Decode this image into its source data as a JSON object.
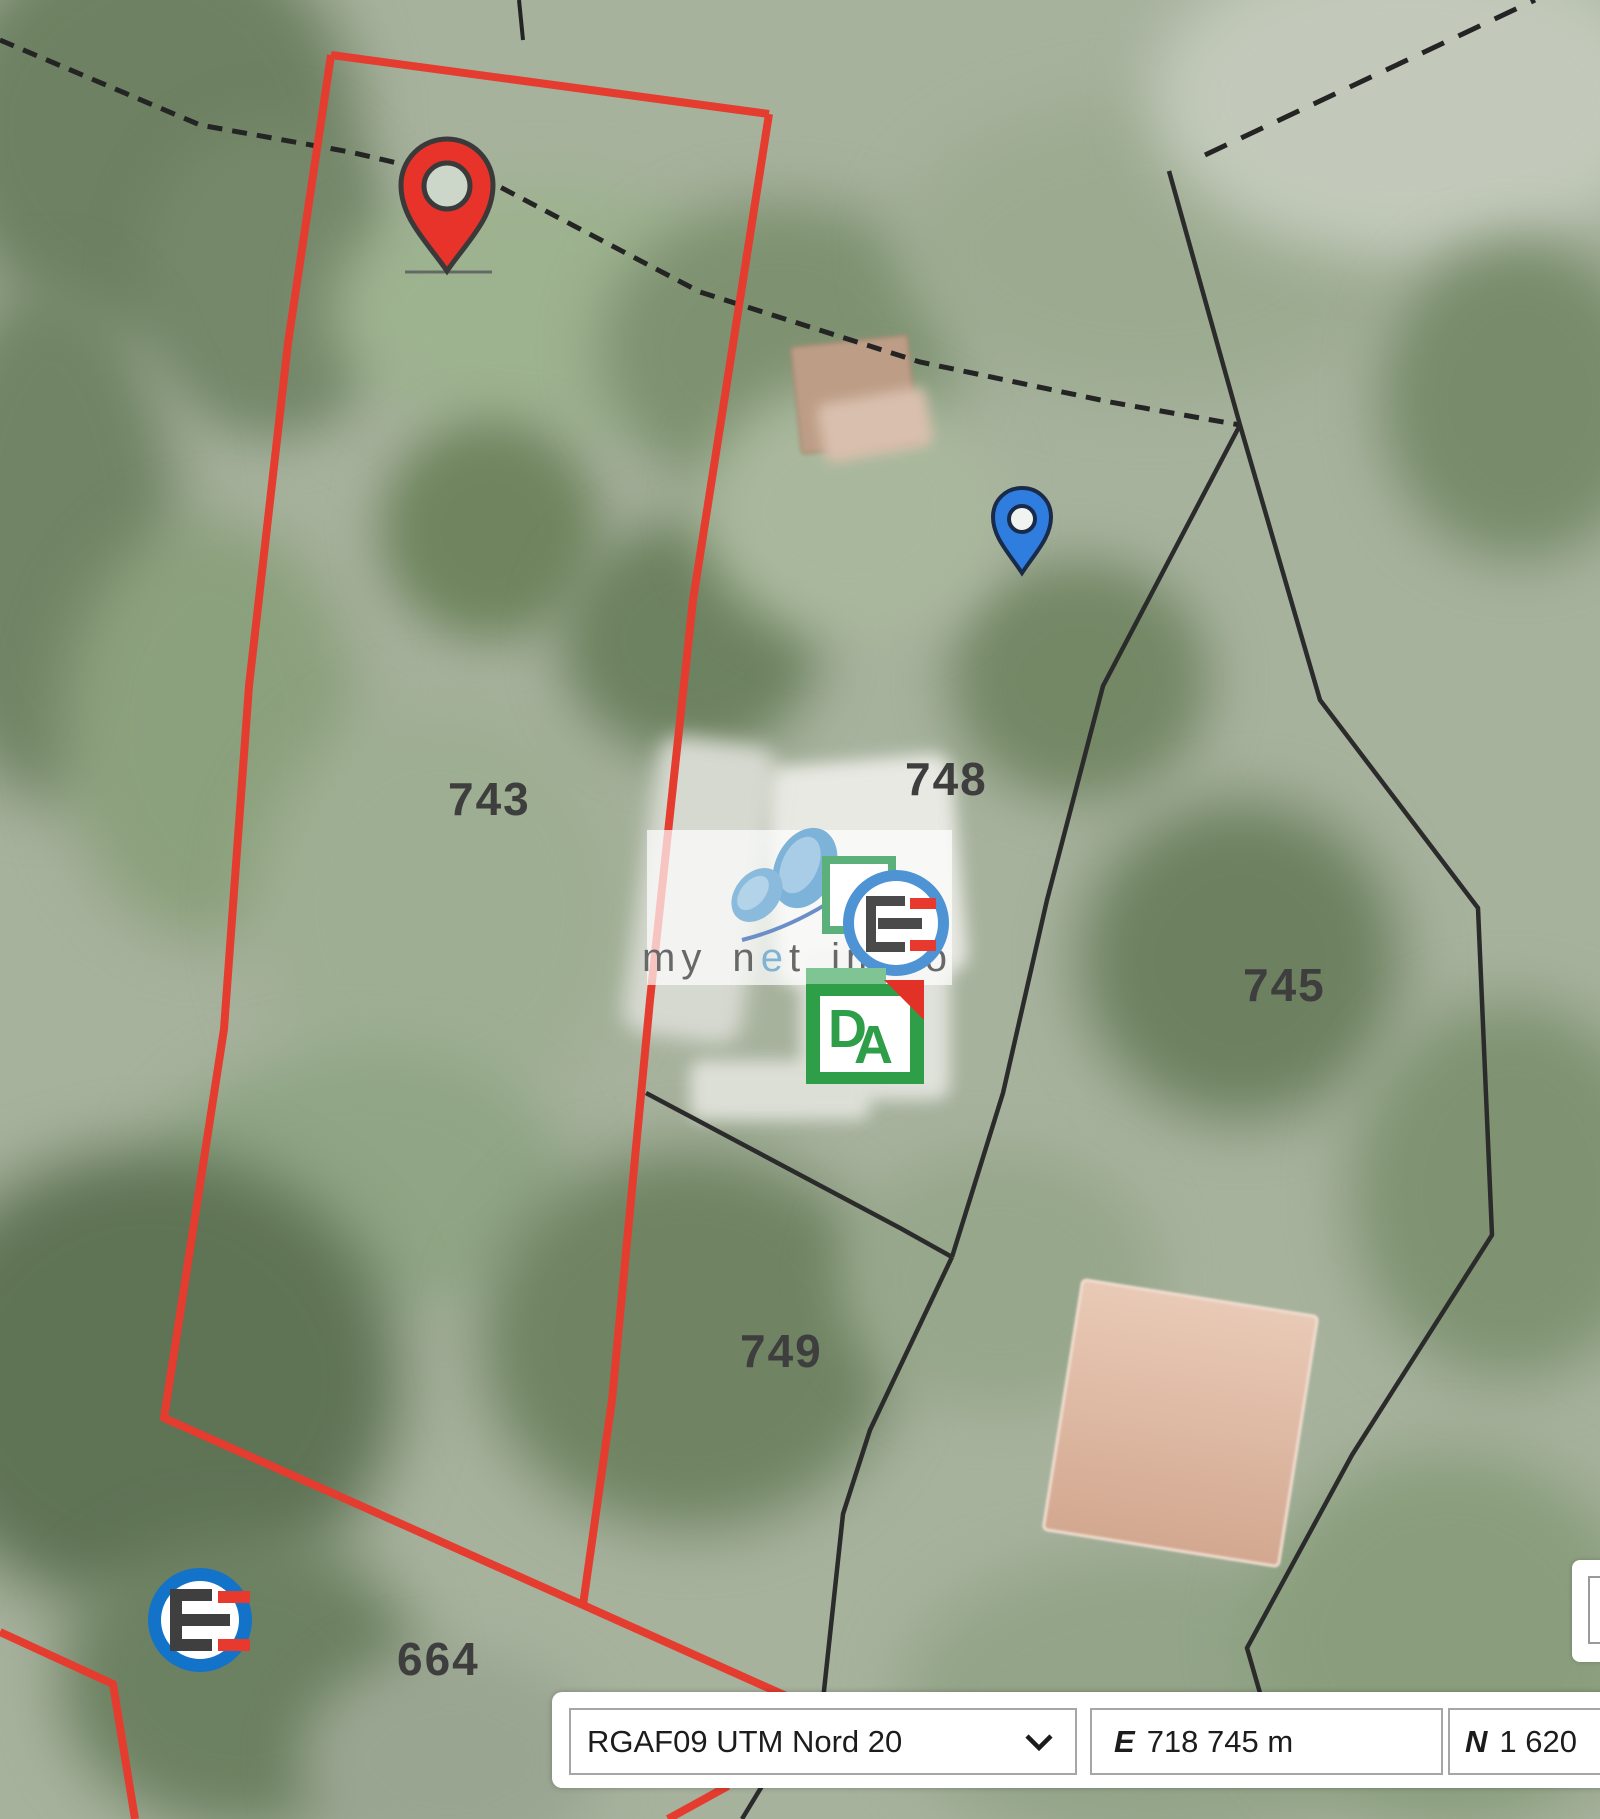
{
  "map": {
    "parcels": [
      {
        "number": "743"
      },
      {
        "number": "748"
      },
      {
        "number": "745"
      },
      {
        "number": "749"
      },
      {
        "number": "664"
      }
    ],
    "markers": [
      {
        "name": "red-marker",
        "color": "#e8332b"
      },
      {
        "name": "blue-marker",
        "color": "#2e7ddf"
      }
    ],
    "line_colors": {
      "selected_parcel": "#e53c30",
      "parcel_boundary": "#2b2b2b"
    }
  },
  "watermark": {
    "brand_pre": "my n",
    "brand_accent": "e",
    "brand_post": "t immo",
    "accent_color": "#7fb3d5",
    "da_logo": {
      "letter_d": "D",
      "letter_a": "A",
      "green": "#2f9e49"
    }
  },
  "logos": {
    "corner_circle_color": "#1273c8"
  },
  "toolbar": {
    "crs_select": {
      "value": "RGAF09 UTM Nord 20"
    },
    "easting_label": "E",
    "easting_value": "718 745 m",
    "northing_label": "N",
    "northing_value": "1 620"
  }
}
